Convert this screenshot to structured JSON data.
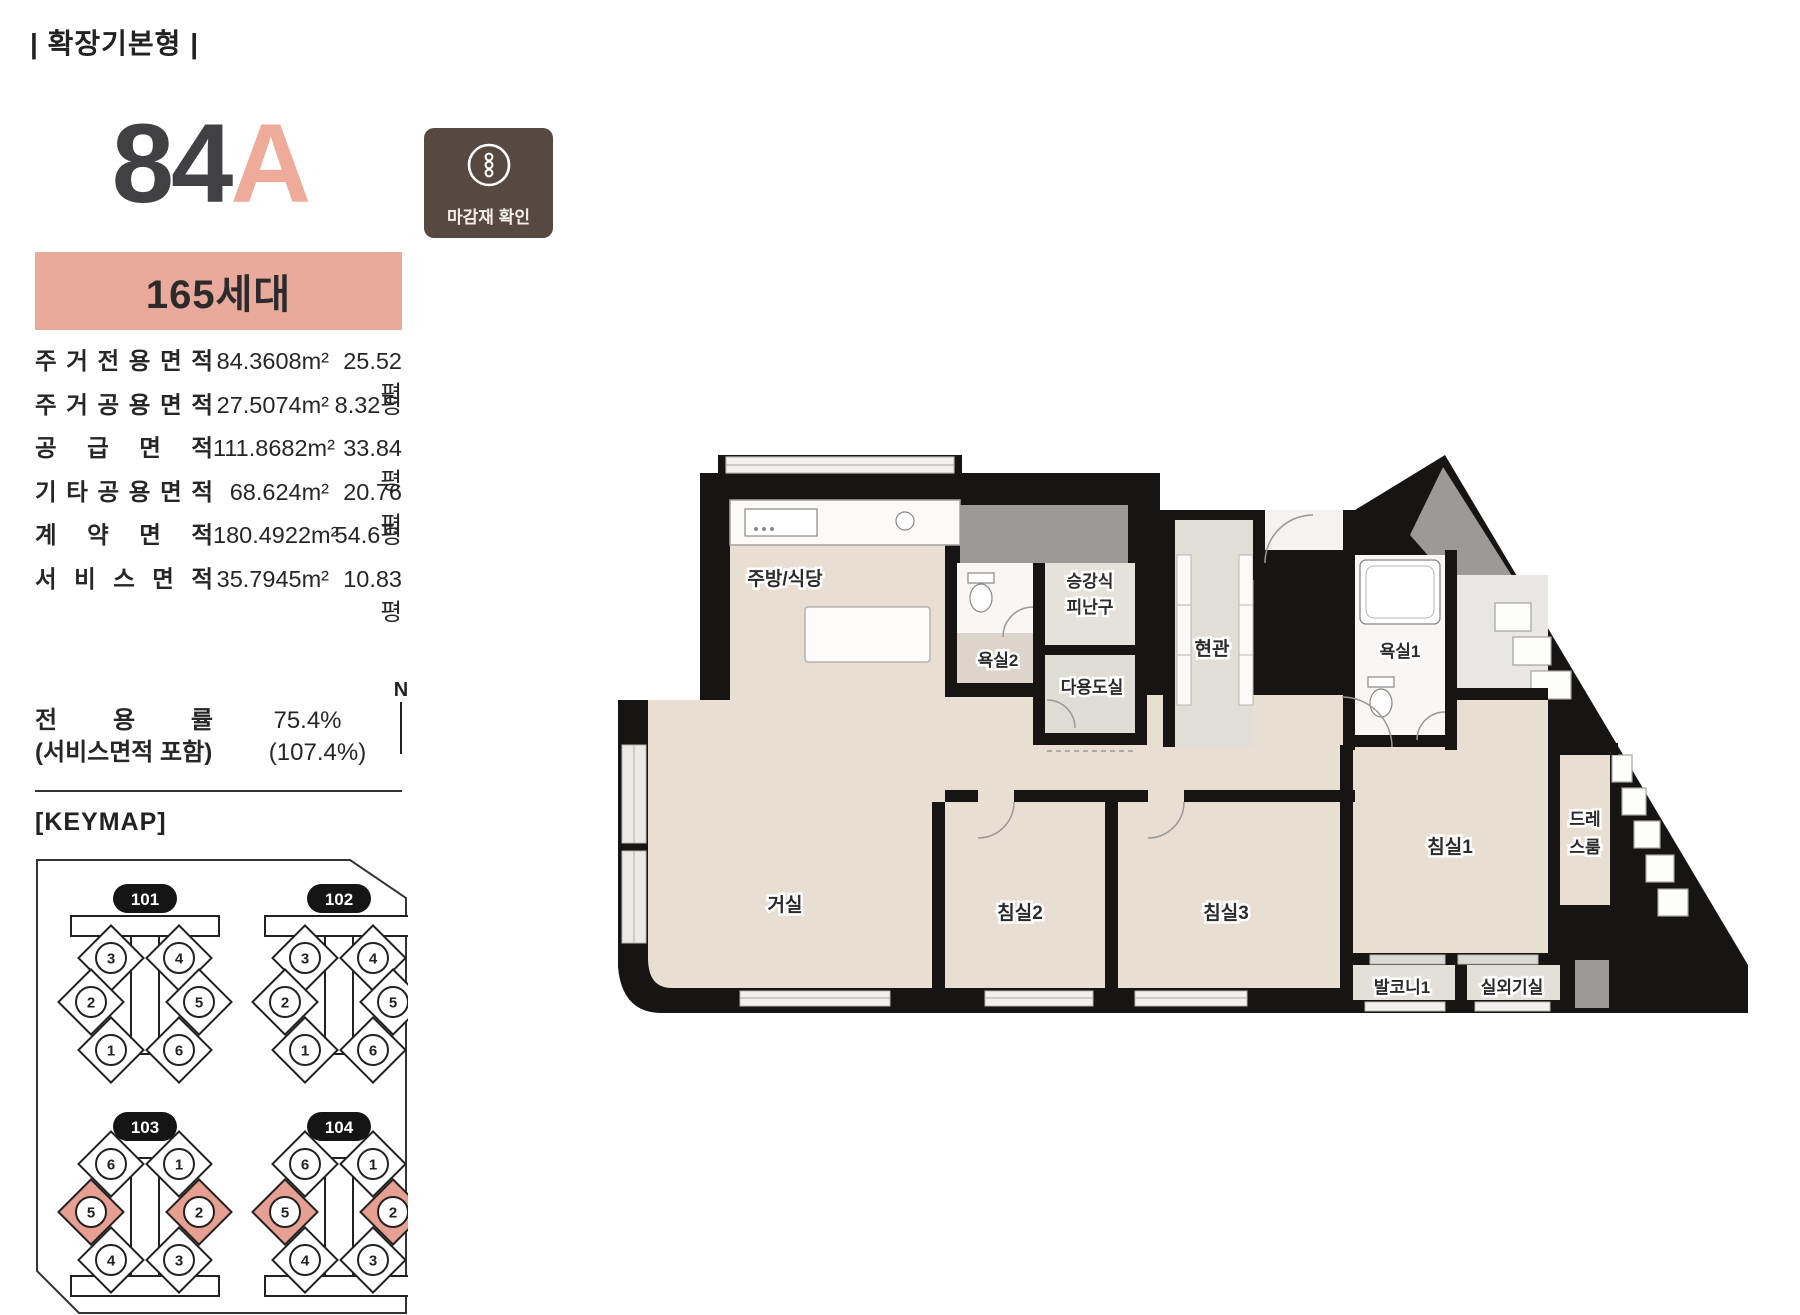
{
  "header": {
    "plan_type": "| 확장기본형 |"
  },
  "unit": {
    "number": "84",
    "letter": "A",
    "households": "165세대"
  },
  "finish_badge": {
    "label": "마감재 확인"
  },
  "area_table": {
    "rows": [
      {
        "label": "주거전용면적",
        "m2": "84.3608m²",
        "pyeong": "25.52평"
      },
      {
        "label": "주거공용면적",
        "m2": "27.5074m²",
        "pyeong": "8.32평"
      },
      {
        "label": "공급면적",
        "m2": "111.8682m²",
        "pyeong": "33.84평"
      },
      {
        "label": "기타공용면적",
        "m2": "68.624m²",
        "pyeong": "20.76평"
      },
      {
        "label": "계약면적",
        "m2": "180.4922m²",
        "pyeong": "54.6평"
      },
      {
        "label": "서비스면적",
        "m2": "35.7945m²",
        "pyeong": "10.83평"
      }
    ]
  },
  "ratio": {
    "label": "전용률",
    "value": "75.4%",
    "sub_label": "(서비스면적 포함)",
    "sub_value": "(107.4%)"
  },
  "keymap": {
    "title": "[KEYMAP]",
    "compass": "N",
    "buildings": [
      {
        "id": "101",
        "flipped": false,
        "units": [
          {
            "n": "3",
            "highlight": false
          },
          {
            "n": "4",
            "highlight": false
          },
          {
            "n": "2",
            "highlight": false
          },
          {
            "n": "5",
            "highlight": false
          },
          {
            "n": "1",
            "highlight": false
          },
          {
            "n": "6",
            "highlight": false
          }
        ]
      },
      {
        "id": "102",
        "flipped": false,
        "units": [
          {
            "n": "3",
            "highlight": false
          },
          {
            "n": "4",
            "highlight": false
          },
          {
            "n": "2",
            "highlight": false
          },
          {
            "n": "5",
            "highlight": false
          },
          {
            "n": "1",
            "highlight": false
          },
          {
            "n": "6",
            "highlight": false
          }
        ]
      },
      {
        "id": "103",
        "flipped": true,
        "units": [
          {
            "n": "6",
            "highlight": false
          },
          {
            "n": "1",
            "highlight": false
          },
          {
            "n": "5",
            "highlight": true
          },
          {
            "n": "2",
            "highlight": true
          },
          {
            "n": "4",
            "highlight": false
          },
          {
            "n": "3",
            "highlight": false
          }
        ]
      },
      {
        "id": "104",
        "flipped": true,
        "units": [
          {
            "n": "6",
            "highlight": false
          },
          {
            "n": "1",
            "highlight": false
          },
          {
            "n": "5",
            "highlight": true
          },
          {
            "n": "2",
            "highlight": true
          },
          {
            "n": "4",
            "highlight": false
          },
          {
            "n": "3",
            "highlight": false
          }
        ]
      }
    ]
  },
  "floorplan": {
    "rooms": {
      "kitchen": "주방/식당",
      "bath2": "욕실2",
      "evac_line1": "승강식",
      "evac_line2": "피난구",
      "utility": "다용도실",
      "entry": "현관",
      "bath1": "욕실1",
      "living": "거실",
      "bed2": "침실2",
      "bed3": "침실3",
      "bed1": "침실1",
      "dress_line1": "드레",
      "dress_line2": "스룸",
      "balcony1": "발코니1",
      "outdoor_unit": "실외기실"
    }
  },
  "colors": {
    "accent_salmon": "#e9a99b",
    "unit_letter": "#eeab9a",
    "keymap_highlight": "#e79f92",
    "badge_brown": "#57493f",
    "wall_black": "#161513",
    "floor_beige": "#e8dfd2",
    "floor_gray": "#e1ded7",
    "shaft_gray": "#9c9a97"
  }
}
